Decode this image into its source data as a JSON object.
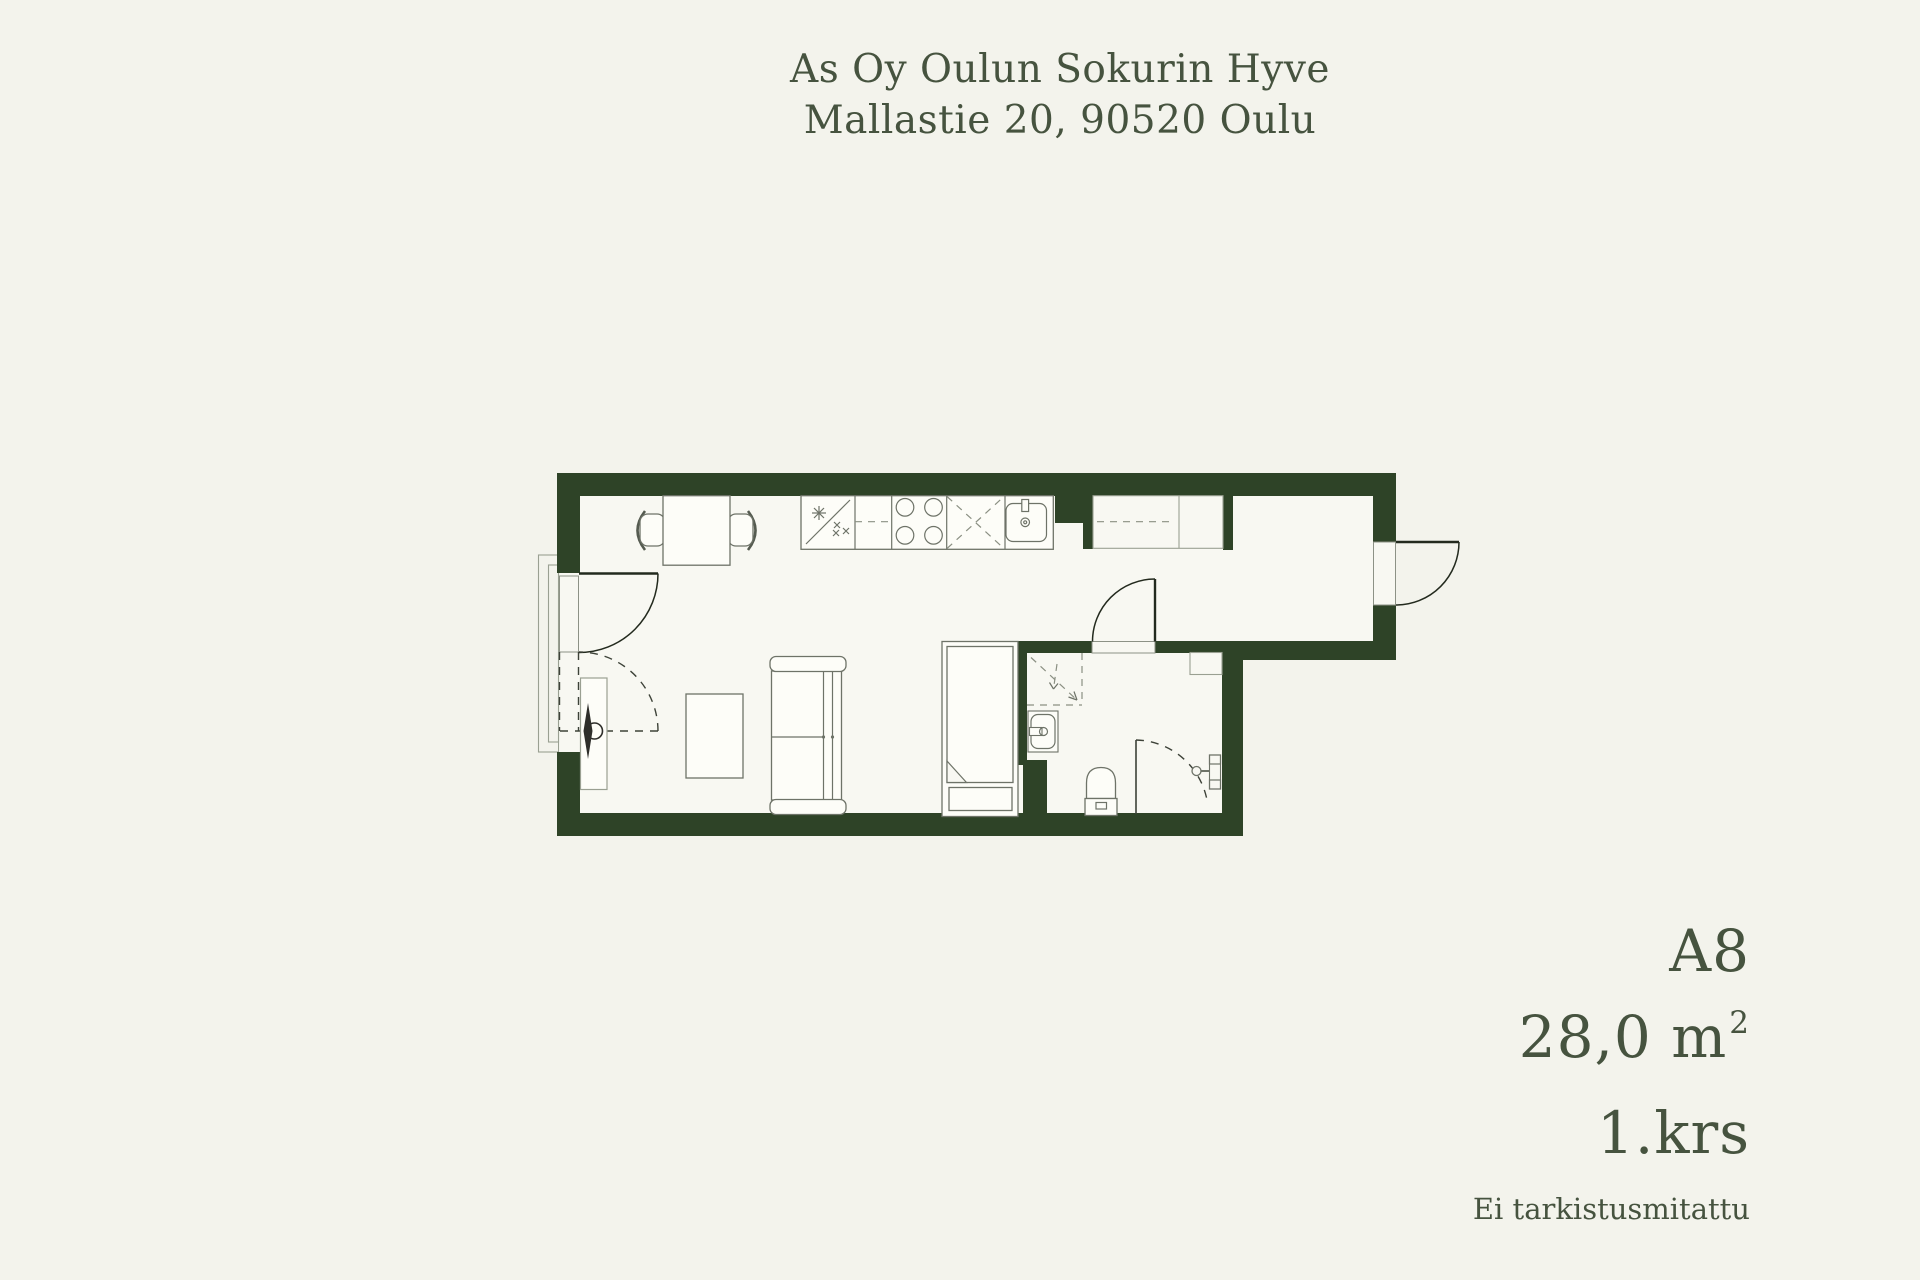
{
  "header": {
    "building_name": "As Oy Oulun Sokurin Hyve",
    "address": "Mallastie 20, 90520 Oulu"
  },
  "unit_info": {
    "unit_id": "A8",
    "area_value": "28,0 m",
    "area_superscript": "2",
    "floor": "1.krs",
    "note": "Ei tarkistusmitattu"
  },
  "colors": {
    "background": "#f3f3ec",
    "floor": "#f8f8f2",
    "wall": "#2e4327",
    "text": "#46533f",
    "line_dark": "#232a1e",
    "line_mid": "#6e7368",
    "line_light": "#9aa092",
    "dash": "#8b9083"
  },
  "floorplan": {
    "legend_items": [
      "dining-table",
      "dining-chair",
      "kitchen-counter",
      "dishwasher",
      "stove",
      "fridge",
      "kitchen-sink",
      "wardrobe",
      "coffee-table",
      "sofa",
      "bed",
      "shower",
      "bathroom-sink",
      "toilet",
      "entrance-door",
      "bathroom-door",
      "exterior-door"
    ]
  }
}
